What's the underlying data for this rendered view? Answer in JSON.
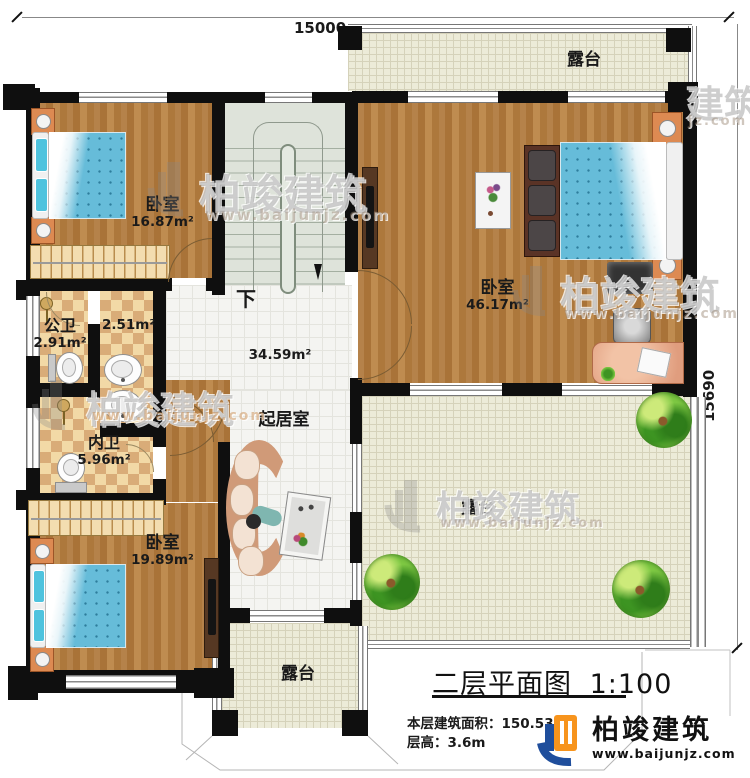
{
  "dimensions": {
    "top": "15000",
    "right": "15690"
  },
  "stair": {
    "down": "下"
  },
  "rooms": {
    "bedroom_top_left": {
      "name": "卧室",
      "area": "16.87m²"
    },
    "bedroom_master": {
      "name": "卧室",
      "area": "46.17m²"
    },
    "bedroom_bottom_left": {
      "name": "卧室",
      "area": "19.89m²"
    },
    "public_bath": {
      "name": "公卫",
      "area": "2.91m²"
    },
    "wash_area": {
      "area": "2.51m²"
    },
    "private_bath": {
      "name": "内卫",
      "area": "5.96m²"
    },
    "living": {
      "name": "起居室",
      "area": "34.59m²"
    },
    "terrace_top": {
      "name": "露台"
    },
    "terrace_right": {
      "name": "露台"
    },
    "terrace_bottom": {
      "name": "露台"
    }
  },
  "title_block": {
    "title": "二层平面图",
    "scale": "1:100",
    "floor_area_label": "本层建筑面积：",
    "floor_area_value": "150.53m²",
    "floor_height_label": "层高：",
    "floor_height_value": "3.6m"
  },
  "brand": {
    "name": "柏竣建筑",
    "url": "www.baijunjz.com"
  },
  "watermark": {
    "name": "柏竣建筑",
    "url": "www.baijunjz.com",
    "partial_name": "建筑",
    "partial_url": "jz.com"
  }
}
